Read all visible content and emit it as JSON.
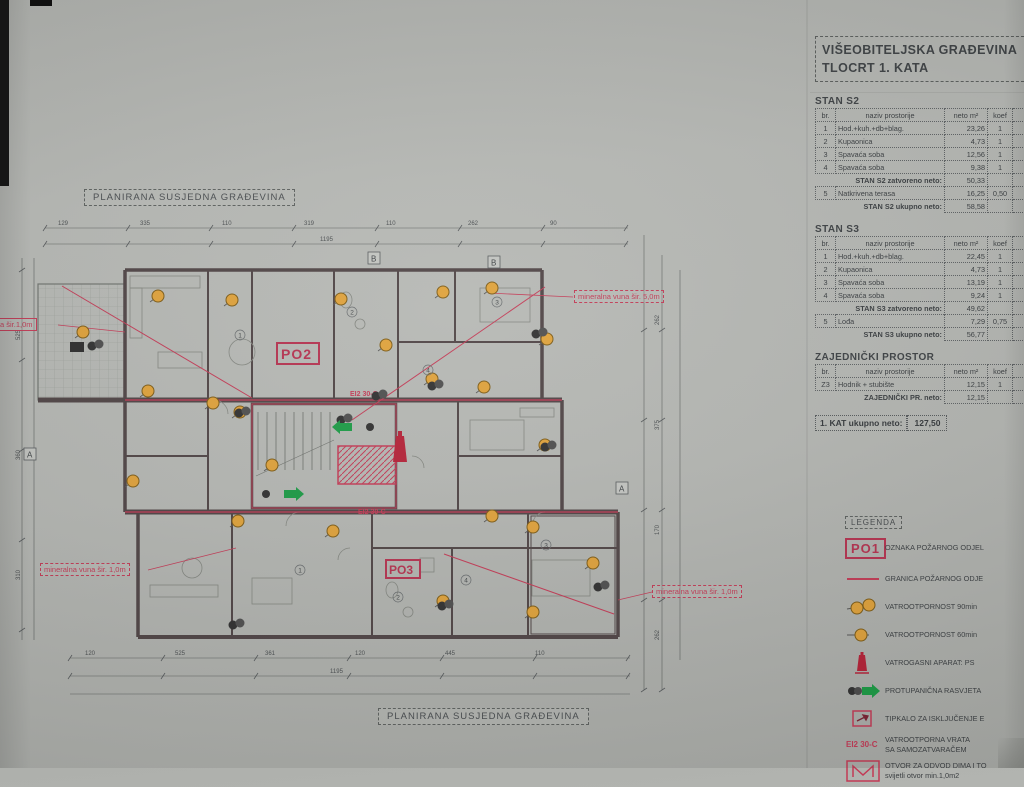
{
  "title": {
    "line1": "VIŠEOBITELJSKA GRAĐEVINA",
    "line2": "TLOCRT 1. KATA"
  },
  "tables": {
    "s2": {
      "title": "STAN S2",
      "headers": [
        "br.",
        "naziv prostorije",
        "neto m²",
        "koef",
        "neto"
      ],
      "rows": [
        [
          "1",
          "Hod.+kuh.+db+blag.",
          "23,26",
          "1"
        ],
        [
          "2",
          "Kupaonica",
          "4,73",
          "1"
        ],
        [
          "3",
          "Spavaća soba",
          "12,56",
          "1"
        ],
        [
          "4",
          "Spavaća soba",
          "9,38",
          "1"
        ]
      ],
      "subtotal_label": "STAN S2 zatvoreno neto:",
      "subtotal": "50,33",
      "rows2": [
        [
          "5",
          "Natkrivena terasa",
          "16,25",
          "0,50"
        ]
      ],
      "total_label": "STAN S2 ukupno neto:",
      "total": "58,58"
    },
    "s3": {
      "title": "STAN S3",
      "headers": [
        "br.",
        "naziv prostorije",
        "neto m²",
        "koef",
        "neto"
      ],
      "rows": [
        [
          "1",
          "Hod.+kuh.+db+blag.",
          "22,45",
          "1"
        ],
        [
          "2",
          "Kupaonica",
          "4,73",
          "1"
        ],
        [
          "3",
          "Spavaća soba",
          "13,19",
          "1"
        ],
        [
          "4",
          "Spavaća soba",
          "9,24",
          "1"
        ]
      ],
      "subtotal_label": "STAN S3 zatvoreno neto:",
      "subtotal": "49,62",
      "rows2": [
        [
          "5",
          "Lođa",
          "7,29",
          "0,75"
        ]
      ],
      "total_label": "STAN S3 ukupno neto:",
      "total": "56,77"
    },
    "common": {
      "title": "ZAJEDNIČKI PROSTOR",
      "headers": [
        "br.",
        "naziv prostorije",
        "neto m²",
        "koef",
        "neto"
      ],
      "rows": [
        [
          "Z3",
          "Hodnik + stubište",
          "12,15",
          "1"
        ]
      ],
      "total_label": "ZAJEDNIČKI PR. neto:",
      "total": "12,15"
    },
    "grand": {
      "label": "1. KAT ukupno neto:",
      "value": "127,50"
    }
  },
  "plan": {
    "top_label": "PLANIRANA SUSJEDNA GRAĐEVINA",
    "bottom_label": "PLANIRANA SUSJEDNA GRAĐEVINA",
    "mineral": {
      "right_top": "mineralna vuna šir. 5,0m",
      "left_mid": "mineralna vuna šir. 1,0m",
      "right_bottom": "mineralna vuna šir. 1,0m",
      "left_edge": "a šir.1,0m"
    },
    "zone_labels": {
      "po2": "PO2",
      "po3": "PO3"
    },
    "door_tags": [
      "EI2 30-C",
      "EI2 30-C"
    ],
    "axis_markers": [
      "B",
      "B",
      "A",
      "A"
    ],
    "room_numbers_upper": [
      "1",
      "2",
      "3",
      "4"
    ],
    "room_numbers_lower": [
      "1",
      "2",
      "3",
      "4"
    ],
    "dims": {
      "top": [
        "129",
        "335",
        "110",
        "319",
        "110",
        "262",
        "90"
      ],
      "top2": [
        "1195"
      ],
      "bottom": [
        "120",
        "525",
        "361",
        "120",
        "445",
        "110"
      ],
      "bottom2": [
        "1195"
      ],
      "left": [
        "310",
        "360",
        "525"
      ],
      "right": [
        "262",
        "170",
        "375",
        "262"
      ]
    }
  },
  "legend": {
    "title": "LEGENDA",
    "po1": "PO1",
    "door_tag": "EI2 30-C",
    "items": [
      {
        "icon": "po1-box-icon",
        "lines": [
          "OZNAKA POŽARNOG ODJEL"
        ]
      },
      {
        "icon": "boundary-line-icon",
        "lines": [
          "GRANICA POŽARNOG ODJE"
        ]
      },
      {
        "icon": "fire-rating-90-icon",
        "lines": [
          "VATROOTPORNOST 90min"
        ]
      },
      {
        "icon": "fire-rating-60-icon",
        "lines": [
          "VATROOTPORNOST 60min"
        ]
      },
      {
        "icon": "extinguisher-icon",
        "lines": [
          "VATROGASNI APARAT: PS"
        ]
      },
      {
        "icon": "panic-light-icon",
        "lines": [
          "PROTUPANIČNA RASVJETA"
        ]
      },
      {
        "icon": "kill-switch-icon",
        "lines": [
          "TIPKALO ZA ISKLJUČENJE E"
        ]
      },
      {
        "icon": "fire-door-icon",
        "lines": [
          "VATROOTPORNA VRATA",
          "SA SAMOZATVARAČEM"
        ]
      },
      {
        "icon": "smoke-vent-icon",
        "lines": [
          "OTVOR ZA ODVOD DIMA I TO",
          "svijetli otvor min.1,0m2"
        ]
      }
    ]
  },
  "colors": {
    "fire_red": "#c23a55",
    "deep_red": "#b4314e",
    "orange": "#dfa139",
    "green": "#1a9a44",
    "wall": "#4e4344",
    "paper": "#b4b6b2"
  }
}
